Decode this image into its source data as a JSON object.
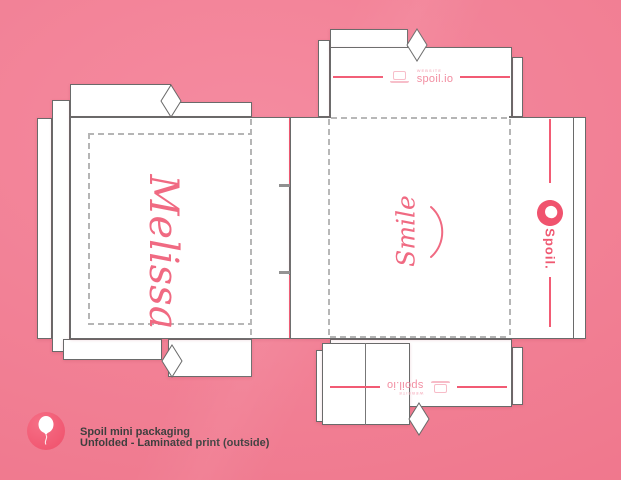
{
  "caption": {
    "title": "Spoil mini packaging",
    "subtitle": "Unfolded - Laminated print (outside)"
  },
  "dieline": {
    "left_panel": {
      "name_script": "Melissa"
    },
    "center_panel": {
      "script": "Smile",
      "decoration": "smile-arc"
    },
    "side_panel": {
      "brand": "Spoil.",
      "logo": "spoil-balloon-logo"
    },
    "top_flap": {
      "label": "WEBSITE",
      "url": "spoil.io",
      "icon": "laptop-icon"
    },
    "bottom_flap": {
      "label": "WEBSITE",
      "url": "spoil.io",
      "icon": "laptop-icon"
    }
  },
  "colors": {
    "background_pink": "#f17e93",
    "accent_pink": "#f25b74",
    "logo_pink": "#f0536e",
    "script_pink": "#f06a82",
    "spoilio_text_pink": "#f28ca0",
    "light_pink": "#f7bcc8",
    "cut_line_gray": "#6a6a6a",
    "fold_dash_gray": "#b5b5b5",
    "caption_text_gray": "#3e3e3e"
  }
}
